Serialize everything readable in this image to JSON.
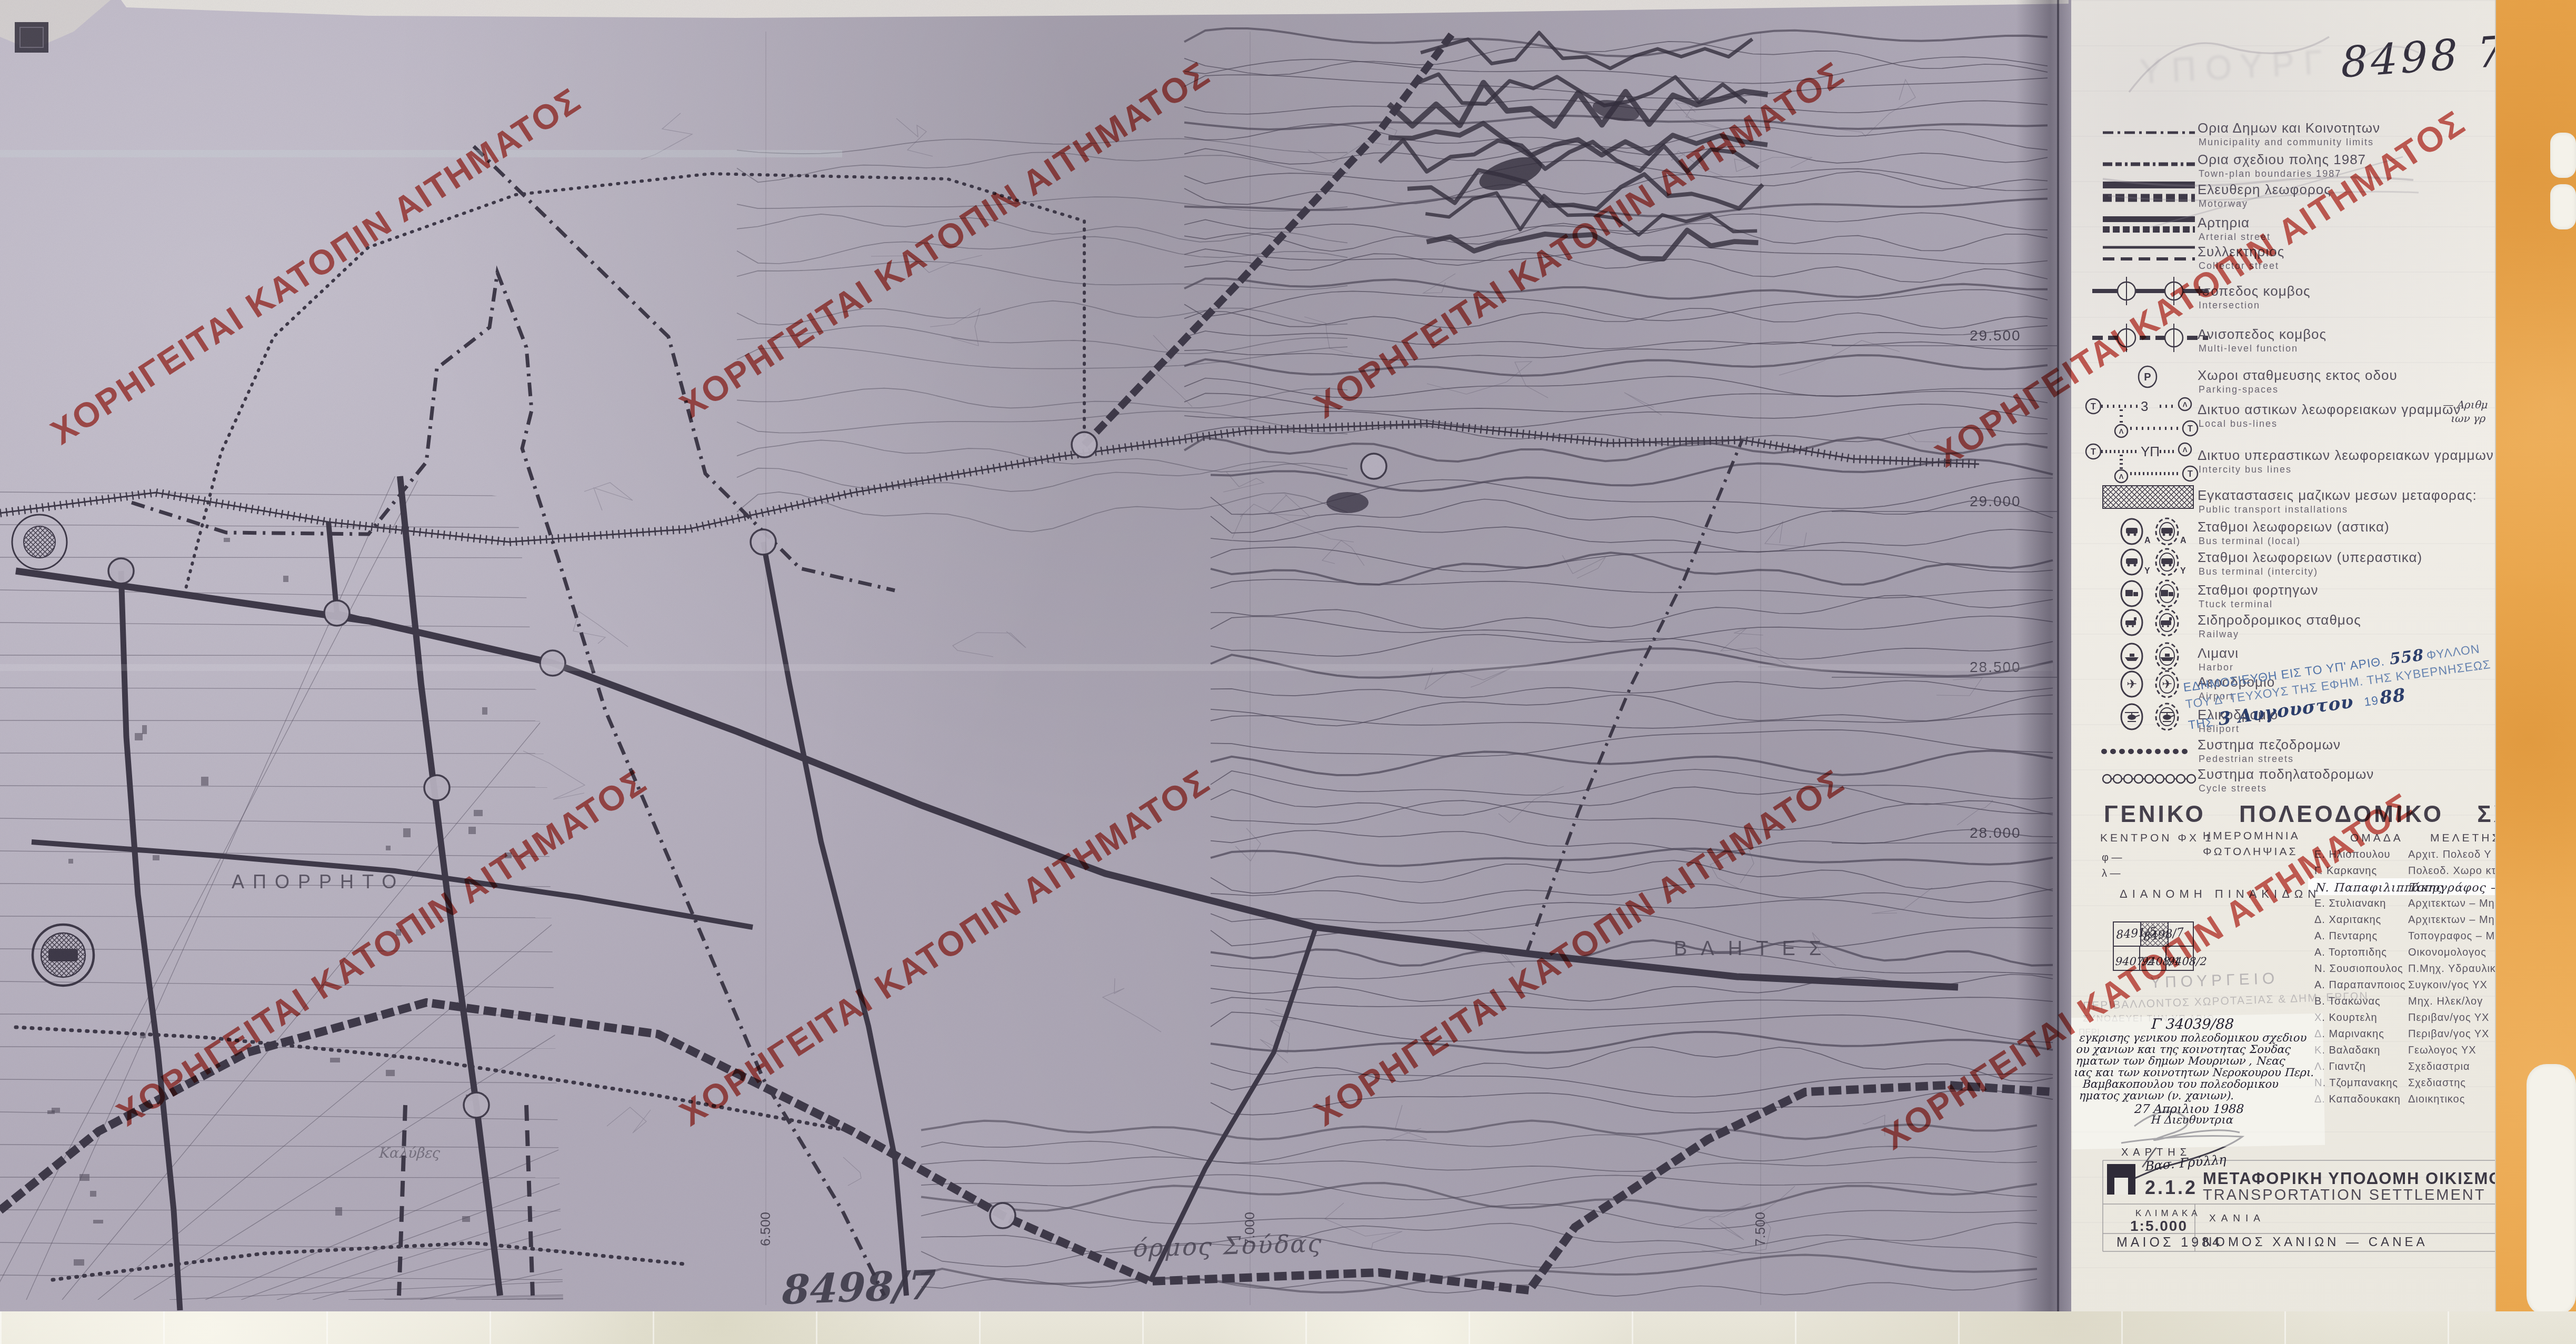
{
  "watermark": {
    "text": "\u03a7\u039f\u03a1\u0397\u0393\u0395\u0399\u03a4\u0391\u0399 \u039a\u0391\u03a4\u039f\u03a0\u0399\u039d \u0391\u0399\u03a4\u0397\u039c\u0391\u03a4\u039f\u03a3",
    "color": "#bf342c"
  },
  "map": {
    "labels": {
      "secret": "\u0391\u03a0\u039f\u03a1\u03a1\u0397\u03a4\u039f",
      "vlites": "\u0392\u039b\u0397\u03a4\u0395\u03a3",
      "kalyves": "\u039a\u03b1\u03bb\u03cd\u03b2\u03b5\u03c2",
      "souda_bay": "\u03cc\u03c1\u03bc\u03bf\u03c2 \u03a3\u03bf\u03cd\u03b4\u03b1\u03c2",
      "sheet_note": "8498/7"
    },
    "grid_labels_right": [
      "29.500",
      "29.000",
      "28.500",
      "28.000"
    ],
    "grid_labels_bottom": [
      "6.500",
      "7.000",
      "7.500"
    ]
  },
  "panel": {
    "handwritten_number": "8498 7",
    "faded_stamp_top": "\u03a5\u03a0\u039f\u03a5\u03a1\u0393",
    "legend": [
      {
        "gr": "\u039f\u03c1\u03b9\u03b1 \u0394\u03b7\u03bc\u03c9\u03bd \u03ba\u03b1\u03b9 \u039a\u03bf\u03b9\u03bd\u03bf\u03c4\u03b7\u03c4\u03c9\u03bd",
        "en": "Municipality and community limits",
        "sym": "boundary-municipal"
      },
      {
        "gr": "\u039f\u03c1\u03b9\u03b1 \u03c3\u03c7\u03b5\u03b4\u03b9\u03bf\u03c5 \u03c0\u03bf\u03bb\u03b7\u03c2 1987",
        "en": "Town-plan boundaries 1987",
        "sym": "boundary-townplan"
      },
      {
        "gr": "\u0395\u03bb\u03b5\u03c5\u03b8\u03b5\u03c1\u03b7 \u03bb\u03b5\u03c9\u03c6\u03bf\u03c1\u03bf\u03c2",
        "en": "Motorway",
        "sym": "motorway"
      },
      {
        "gr": "\u0391\u03c1\u03c4\u03b7\u03c1\u03b9\u03b1",
        "en": "Arterial street",
        "sym": "arterial"
      },
      {
        "gr": "\u03a3\u03c5\u03bb\u03bb\u03b5\u03ba\u03c4\u03b7\u03c1\u03b9\u03bf\u03c2",
        "en": "Collector street",
        "sym": "collector"
      },
      {
        "gr": "\u0399\u03c3\u03bf\u03c0\u03b5\u03b4\u03bf\u03c2 \u03ba\u03bf\u03bc\u03b2\u03bf\u03c2",
        "en": "Intersection",
        "sym": "intersection"
      },
      {
        "gr": "\u0391\u03bd\u03b9\u03c3\u03bf\u03c0\u03b5\u03b4\u03bf\u03c2 \u03ba\u03bf\u03bc\u03b2\u03bf\u03c2",
        "en": "Multi-level function",
        "sym": "multilevel"
      },
      {
        "gr": "\u03a7\u03c9\u03c1\u03bf\u03b9 \u03c3\u03c4\u03b1\u03b8\u03bc\u03b5\u03c5\u03c3\u03b7\u03c2 \u03b5\u03ba\u03c4\u03bf\u03c2 \u03bf\u03b4\u03bf\u03c5",
        "en": "Parking-spaces",
        "sym": "parking"
      },
      {
        "gr": "\u0394\u03b9\u03ba\u03c4\u03c5\u03bf \u03b1\u03c3\u03c4\u03b9\u03ba\u03c9\u03bd \u03bb\u03b5\u03c9\u03c6\u03bf\u03c1\u03b5\u03b9\u03b1\u03ba\u03c9\u03bd \u03b3\u03c1\u03b1\u03bc\u03bc\u03c9\u03bd",
        "en": "Local bus-lines",
        "sym": "bus-local",
        "sym_label": "3",
        "note1": "\u2014 \u0391\u03c1\u03b9\u03b8\u03bc",
        "note2": "\u03b9\u03c9\u03bd \u03b3\u03c1"
      },
      {
        "gr": "\u0394\u03b9\u03ba\u03c4\u03c5\u03bf \u03c5\u03c0\u03b5\u03c1\u03b1\u03c3\u03c4\u03b9\u03ba\u03c9\u03bd \u03bb\u03b5\u03c9\u03c6\u03bf\u03c1\u03b5\u03b9\u03b1\u03ba\u03c9\u03bd \u03b3\u03c1\u03b1\u03bc\u03bc\u03c9\u03bd",
        "en": "Intercity bus lines",
        "sym": "bus-intercity",
        "sym_label": "\u03a5\u03a0"
      },
      {
        "gr": "\u0395\u03b3\u03ba\u03b1\u03c4\u03b1\u03c3\u03c4\u03b1\u03c3\u03b5\u03b9\u03c2 \u03bc\u03b1\u03b6\u03b9\u03ba\u03c9\u03bd \u03bc\u03b5\u03c3\u03c9\u03bd \u03bc\u03b5\u03c4\u03b1\u03c6\u03bf\u03c1\u03b1\u03c2:",
        "en": "Public transport installations",
        "sym": "installations"
      },
      {
        "gr": "\u03a3\u03c4\u03b1\u03b8\u03bc\u03bf\u03b9 \u03bb\u03b5\u03c9\u03c6\u03bf\u03c1\u03b5\u03b9\u03c9\u03bd (\u03b1\u03c3\u03c4\u03b9\u03ba\u03b1)",
        "en": "Bus terminal (local)",
        "sym": "terminal-bus",
        "letter": "A"
      },
      {
        "gr": "\u03a3\u03c4\u03b1\u03b8\u03bc\u03bf\u03b9 \u03bb\u03b5\u03c9\u03c6\u03bf\u03c1\u03b5\u03b9\u03c9\u03bd (\u03c5\u03c0\u03b5\u03c1\u03b1\u03c3\u03c4\u03b9\u03ba\u03b1)",
        "en": "Bus terminal (intercity)",
        "sym": "terminal-bus",
        "letter": "Y"
      },
      {
        "gr": "\u03a3\u03c4\u03b1\u03b8\u03bc\u03bf\u03b9 \u03c6\u03bf\u03c1\u03c4\u03b7\u03b3\u03c9\u03bd",
        "en": "Ttuck terminal",
        "sym": "truck"
      },
      {
        "gr": "\u03a3\u03b9\u03b4\u03b7\u03c1\u03bf\u03b4\u03c1\u03bf\u03bc\u03b9\u03ba\u03bf\u03c2 \u03c3\u03c4\u03b1\u03b8\u03bc\u03bf\u03c2",
        "en": "Railway",
        "sym": "railway"
      },
      {
        "gr": "\u039b\u03b9\u03bc\u03b1\u03bd\u03b9",
        "en": "Harbor",
        "sym": "harbor"
      },
      {
        "gr": "\u0391\u03b5\u03c1\u03bf\u03b4\u03c1\u03bf\u03bc\u03b9\u03bf",
        "en": "Airport",
        "sym": "airport"
      },
      {
        "gr": "\u0395\u03bb\u03b9\u03ba\u03bf\u03b4\u03c1\u03bf\u03bc\u03b9\u03bf",
        "en": "Heliport",
        "sym": "heliport"
      },
      {
        "gr": "\u03a3\u03c5\u03c3\u03c4\u03b7\u03bc\u03b1 \u03c0\u03b5\u03b6\u03bf\u03b4\u03c1\u03bf\u03bc\u03c9\u03bd",
        "en": "Pedestrian streets",
        "sym": "pedestrian"
      },
      {
        "gr": "\u03a3\u03c5\u03c3\u03c4\u03b7\u03bc\u03b1 \u03c0\u03bf\u03b4\u03b7\u03bb\u03b1\u03c4\u03bf\u03b4\u03c1\u03bf\u03bc\u03c9\u03bd",
        "en": "Cycle streets",
        "sym": "cycle"
      }
    ],
    "blue_stamp": {
      "l1a": "\u0395\u0394\u0397\u039c\u039f\u03a3\u0399\u0395\u03a5\u0398\u0397 \u0395\u0399\u03a3 \u03a4\u039f \u03a5\u03a0' \u0391\u03a1\u0399\u0398.",
      "hand1": "558",
      "l1b": "\u03a6\u03a5\u039b\u039b\u039f\u039d",
      "l2": "\u03a4\u039f\u03a5 \u0394' \u03a4\u0395\u03a5\u03a7\u039f\u03a5\u03a3 \u03a4\u0397\u03a3 \u0395\u03a6\u0397\u039c. \u03a4\u0397\u03a3 \u039a\u03a5\u0392\u0395\u03a1\u039d\u0397\u03a3\u0395\u03a9\u03a3",
      "l3a": "\u03a4\u0397\u03a3",
      "hand2": "3 \u0391\u03c5\u03b3\u03bf\u03c5\u03c3\u03c4\u03bf\u03c5",
      "l3b": "19",
      "hand3": "88",
      "color": "#5173a8"
    },
    "title": "\u0393\u0395\u039d\u0399\u039a\u039f \u03a0\u039f\u039b\u0395\u039f\u0394\u039f\u039c\u0399\u039a\u039f \u03a3\u03a7\u0395\u0394\u0399\u039f",
    "meta": {
      "kentron": "\u039a\u0395\u039d\u03a4\u03a1\u039f\u039d \u03a6\u03a7 1",
      "phi": "\u03c6 \u2014",
      "lambda": "\u03bb \u2014",
      "date_label1": "\u0397\u039c\u0395\u03a1\u039f\u039c\u0397\u039d\u0399\u0391",
      "date_label2": "\u03a6\u03a9\u03a4\u039f\u039b\u0397\u03a8\u0399\u0391\u03a3",
      "team_header1": "\u039f\u039c\u0391\u0394\u0391",
      "team_header2": "\u039c\u0395\u039b\u0395\u03a4\u0397\u03a3"
    },
    "team": [
      {
        "name": "\u0395. \u0397\u03bb\u03b9\u03bf\u03c0\u03bf\u03c5\u03bb\u03bf\u03c5",
        "role": "\u0391\u03c1\u03c7\u03b9\u03c4.  \u03a0\u03bf\u03bb\u03b5\u03bf\u03b4 \u03a5"
      },
      {
        "name": "\u0393. \u039a\u03b1\u03c1\u03ba\u03b1\u03bd\u03b7\u03c2",
        "role": "\u03a0\u03bf\u03bb\u03b5\u03bf\u03b4.  \u03a7\u03c9\u03c1\u03bf \u03ba\u03c4"
      },
      {
        "name": "\u039d. \u03a0\u03b1\u03c0\u03b1\u03c6\u03b9\u03bb\u03b9\u03c0\u03c0\u03ac\u03ba\u03b7\u03c2",
        "role": "\u03a4\u03bf\u03c0\u03bf\u03b3\u03c1\u03ac\u03c6\u03bf\u03c2 \u2013 \u039c\u03b7",
        "handwritten": true
      },
      {
        "name": "\u0395. \u03a3\u03c4\u03c5\u03bb\u03b9\u03b1\u03bd\u03b1\u03ba\u03b7",
        "role": "\u0391\u03c1\u03c7\u03b9\u03c4\u03b5\u03ba\u03c4\u03c9\u03bd \u2013 \u039c\u03b7"
      },
      {
        "name": "\u0394. \u03a7\u03b1\u03c1\u03b9\u03c4\u03b1\u03ba\u03b7\u03c2",
        "role": "\u0391\u03c1\u03c7\u03b9\u03c4\u03b5\u03ba\u03c4\u03c9\u03bd \u2013 \u039c\u03b7"
      },
      {
        "name": "\u0391. \u03a0\u03b5\u03bd\u03c4\u03b1\u03c1\u03b7\u03c2",
        "role": "\u03a4\u03bf\u03c0\u03bf\u03b3\u03c1\u03b1\u03c6\u03bf\u03c2 \u2013 \u039c\u03b7"
      },
      {
        "name": "\u0391. \u03a4\u03bf\u03c1\u03c4\u03bf\u03c0\u03b9\u03b4\u03b7\u03c2",
        "role": "\u039f\u03b9\u03ba\u03bf\u03bd\u03bf\u03bc\u03bf\u03bb\u03bf\u03b3\u03bf\u03c2"
      },
      {
        "name": "\u039d. \u03a3\u03bf\u03c5\u03c3\u03b9\u03bf\u03c0\u03bf\u03c5\u03bb\u03bf\u03c2",
        "role": "\u03a0.\u039c\u03b7\u03c7. \u03a5\u03b4\u03c1\u03b1\u03c5\u03bb\u03b9\u03ba"
      },
      {
        "name": "\u0391. \u03a0\u03b1\u03c1\u03b1\u03c0\u03b1\u03bd\u03c0\u03bf\u03b9\u03bf\u03c2",
        "role": "\u03a3\u03c5\u03b3\u03ba\u03bf\u03b9\u03bd/\u03b3\u03bf\u03c2  \u03a5\u03a7"
      },
      {
        "name": "\u0392. \u03a4\u03c3\u03b1\u03ba\u03c9\u03bd\u03b1\u03c2",
        "role": "\u039c\u03b7\u03c7.  \u0397\u03bb\u03b5\u03ba/\u03bb\u03bf\u03b3"
      },
      {
        "name": "\u03a7. \u039a\u03bf\u03c5\u03c1\u03c4\u03b5\u03bb\u03b7",
        "role": "\u03a0\u03b5\u03c1\u03b9\u03b2\u03b1\u03bd/\u03b3\u03bf\u03c2  \u03a5\u03a7"
      },
      {
        "name": "\u0394. \u039c\u03b1\u03c1\u03b9\u03bd\u03b1\u03ba\u03b7\u03c2",
        "role": "\u03a0\u03b5\u03c1\u03b9\u03b2\u03b1\u03bd/\u03b3\u03bf\u03c2  \u03a5\u03a7"
      },
      {
        "name": "\u039a. \u0392\u03b1\u03bb\u03b1\u03b4\u03b1\u03ba\u03b7",
        "role": "\u0393\u03b5\u03c9\u03bb\u03bf\u03b3\u03bf\u03c2  \u03a5\u03a7"
      },
      {
        "name": "\u039b. \u0393\u03b9\u03b1\u03bd\u03c4\u03b6\u03b7",
        "role": "\u03a3\u03c7\u03b5\u03b4\u03b9\u03b1\u03c3\u03c4\u03c1\u03b9\u03b1"
      },
      {
        "name": "\u039d. \u03a4\u03b6\u03bf\u03bc\u03c0\u03b1\u03bd\u03b1\u03ba\u03b7\u03c2",
        "role": "\u03a3\u03c7\u03b5\u03b4\u03b9\u03b1\u03c3\u03c4\u03b7\u03c2"
      },
      {
        "name": "\u0394. \u039a\u03b1\u03c0\u03b1\u03b4\u03bf\u03c5\u03ba\u03b1\u03ba\u03b7",
        "role": "\u0394\u03b9\u03bf\u03b9\u03ba\u03b7\u03c4\u03b9\u03ba\u03bf\u03c2"
      }
    ],
    "dianomi": {
      "label": "\u0394\u0399\u0391\u039d\u039f\u039c\u0397 \u03a0\u0399\u039d\u0391\u039a\u0399\u0394\u03a9\u039d",
      "cells_top": [
        "8491/5",
        "8498/7"
      ],
      "cells_bottom": [
        "9407/2",
        "9408/1",
        "9408/2"
      ]
    },
    "ministry_stamp": [
      "\u03a5\u03a0\u039f\u03a5\u03a1\u0393\u0395\u0399\u039f",
      "\u03a0\u0395\u03a1\u0399\u0392\u0391\u039b\u039b\u039f\u039d\u03a4\u039f\u03a3 \u03a7\u03a9\u03a1\u039f\u03a4\u0391\u039e\u0399\u0391\u03a3 & \u0394\u0397\u039c. \u0395\u03a1\u0393\u03a9\u039d",
      "\u03a3\u03a5\u039d\u039f\u0394\u0395\u03a5\u0395\u0399 \u03a4\u0397\u039d \u03a5\u03a0 \u0391\u03a1\u0399\u0398.",
      "\u03a0\u0395\u03a1\u0399"
    ],
    "note": {
      "ref": "\u0393 34039/88",
      "lines": [
        "\u03b5\u03b3\u03ba\u03c1\u03b9\u03c3\u03b7\u03c2 \u03b3\u03b5\u03bd\u03b9\u03ba\u03bf\u03c5 \u03c0\u03bf\u03bb\u03b5\u03bf\u03b4\u03bf\u03bc\u03b9\u03ba\u03bf\u03c5 \u03c3\u03c7\u03b5\u03b4\u03b9\u03bf\u03c5",
        "\u03bf\u03c5 \u03c7\u03b1\u03bd\u03b9\u03c9\u03bd \u03ba\u03b1\u03b9 \u03c4\u03b7\u03c2 \u03ba\u03bf\u03b9\u03bd\u03bf\u03c4\u03b7\u03c4\u03b1\u03c2 \u03a3\u03bf\u03c5\u03b4\u03b1\u03c2",
        "\u03b7\u03bc\u03b1\u03c4\u03c9\u03bd \u03c4\u03c9\u03bd \u03b4\u03b7\u03bc\u03c9\u03bd \u039c\u03bf\u03c5\u03c1\u03bd\u03b9\u03c9\u03bd , \u039d\u03b5\u03b1\u03c2",
        "\u03b9\u03b1\u03c2 \u03ba\u03b1\u03b9 \u03c4\u03c9\u03bd \u03ba\u03bf\u03b9\u03bd\u03bf\u03c4\u03b7\u03c4\u03c9\u03bd \u039d\u03b5\u03c1\u03bf\u03ba\u03bf\u03c5\u03c1\u03bf\u03c5 \u03a0\u03b5\u03c1\u03b9.",
        "\u0392\u03b1\u03bc\u03b2\u03b1\u03ba\u03bf\u03c0\u03bf\u03c5\u03bb\u03bf\u03c5 \u03c4\u03bf\u03c5 \u03c0\u03bf\u03bb\u03b5\u03bf\u03b4\u03bf\u03bc\u03b9\u03ba\u03bf\u03c5",
        "\u03b7\u03bc\u03b1\u03c4\u03bf\u03c2 \u03c7\u03b1\u03bd\u03b9\u03c9\u03bd (\u03bd. \u03c7\u03b1\u03bd\u03b9\u03c9\u03bd)."
      ],
      "date": "27 \u0391\u03c0\u03c1\u03b9\u03bb\u03b9\u03bf\u03c5 1988",
      "signer_title": "\u0397 \u0394\u03b9\u03b5\u03c5\u03b8\u03c5\u03bd\u03c4\u03c1\u03b9\u03b1",
      "signature": "\u0392\u03b1\u03c3. \u0393\u03c1\u03cd\u03bb\u03bb\u03b7"
    },
    "titleblock": {
      "map_label": "\u03a7\u0391\u03a1\u03a4\u0397\u03a3",
      "pi_symbol": "\u03a0",
      "number": "2.1.2",
      "title_gr": "\u039c\u0395\u03a4\u0391\u03a6\u039f\u03a1\u0399\u039a\u0397 \u03a5\u03a0\u039f\u0394\u039f\u039c\u0397 \u039f\u0399\u039a\u0399\u03a3\u039c\u039f\u03a3",
      "title_en": "TRANSPORTATION SETTLEMENT",
      "scale_label": "\u039a\u039b\u0399\u039c\u0391\u039a\u0391",
      "scale": "1:5.000",
      "city": "\u03a7\u0391\u039d\u0399\u0391",
      "date": "\u039c\u0391\u0399\u039f\u03a3 1984",
      "nomos": "\u039d\u039f\u039c\u039f\u03a3   \u03a7\u0391\u039d\u0399\u03a9\u039d   \u2014   CANEA"
    }
  }
}
